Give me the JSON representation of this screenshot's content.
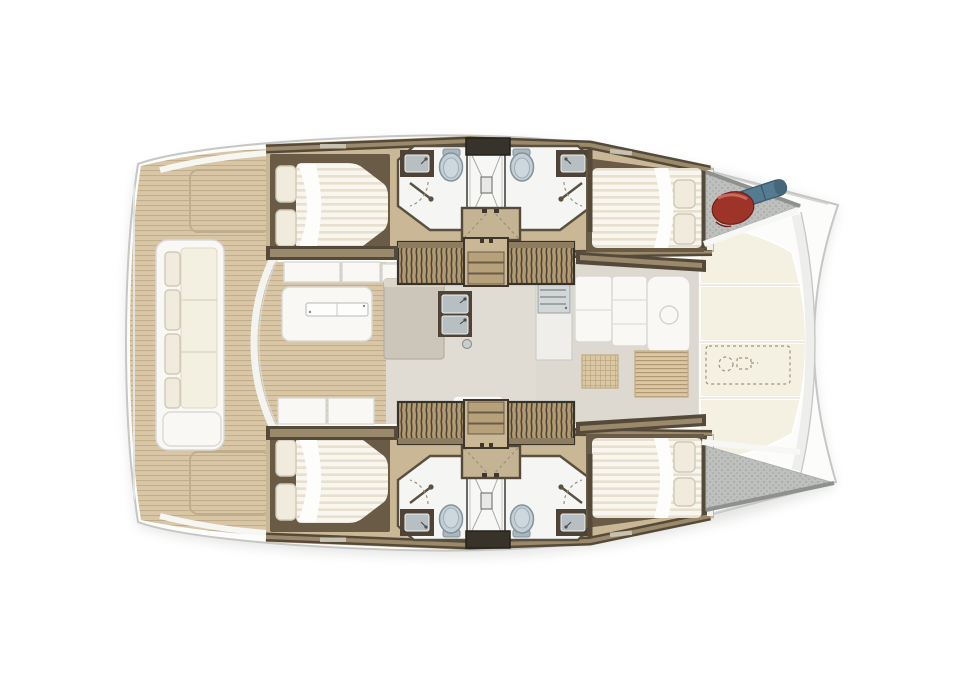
{
  "diagram": {
    "kind": "catamaran-deck-floor-plan",
    "view": "top-down",
    "orientation": "bow-right-stern-left",
    "background": "#ffffff"
  },
  "features": {
    "hulls": [
      "port-hull-top",
      "starboard-hull-bottom"
    ],
    "cabins": [
      "port-aft-cabin",
      "port-forward-cabin",
      "starboard-aft-cabin",
      "starboard-forward-cabin"
    ],
    "beds": 4,
    "bathrooms": 4,
    "toilets": 4,
    "sinks": 4,
    "shower-stalls": 2,
    "shower-heads": 4,
    "wardrobes": 2,
    "staircases": 4,
    "salon": [
      "cockpit-bench",
      "dining-table",
      "bench-seats",
      "galley-island",
      "double-sink",
      "cooktop",
      "lounge-sofa",
      "lounge-table",
      "rattan-poufs"
    ],
    "foredeck": [
      "sunpad-panels",
      "windlass-hatch-dashed",
      "bow-deck-edge"
    ],
    "bow-gear": [
      "red-fender",
      "blue-fender-roll",
      "anchor-locker-top",
      "anchor-locker-bottom"
    ]
  },
  "colors": {
    "hull_fill": "#fcfcfa",
    "hull_stroke": "#c6c7c5",
    "inner_line": "#dcdddb",
    "shadow": "#e4e5e3",
    "teak": "#d8c6a6",
    "teak_line": "#c2ae8a",
    "wood_dark": "#554a3a",
    "wood_mid": "#9a8a6b",
    "floor_tan": "#c9b795",
    "floor_salon": "#e0dcd3",
    "floor_salon2": "#dad6cd",
    "room_white": "#f5f5f3",
    "white_furn": "#f9f8f5",
    "furn_stroke": "#d9d9d6",
    "cushion": "#f3efe1",
    "cushion_stroke": "#ddd7c5",
    "pillow": "#f0ebdc",
    "pillow_stroke": "#cfc9b6",
    "mattress_stripe": "#e2dbc6",
    "toilet": "#c3cfd6",
    "toilet_stroke": "#84929c",
    "counter_dark": "#4e4336",
    "basin": "#b7bfc2",
    "stairs_wood": "#b29a72",
    "stairs_stripe": "#4f4536",
    "step_wood": "#b7a17b",
    "rattan": "#d9c8a3",
    "rattan_line": "#b19873",
    "sunpad": "#f4f1e3",
    "sunpad_line": "#dbd7c6",
    "locker_gray": "#bec0be",
    "locker_dot": "#9fa19f",
    "locker_edge": "#8f918f",
    "fender_red": "#9e332a",
    "fender_red_dark": "#6f1f18",
    "fender_red_hi": "#c96a5c",
    "fender_blue": "#547b92",
    "fender_blue_dark": "#3a5a6d",
    "hatch_dark": "#37322a",
    "dash": "#9a927c",
    "bed_platform": "#6a5b47"
  }
}
